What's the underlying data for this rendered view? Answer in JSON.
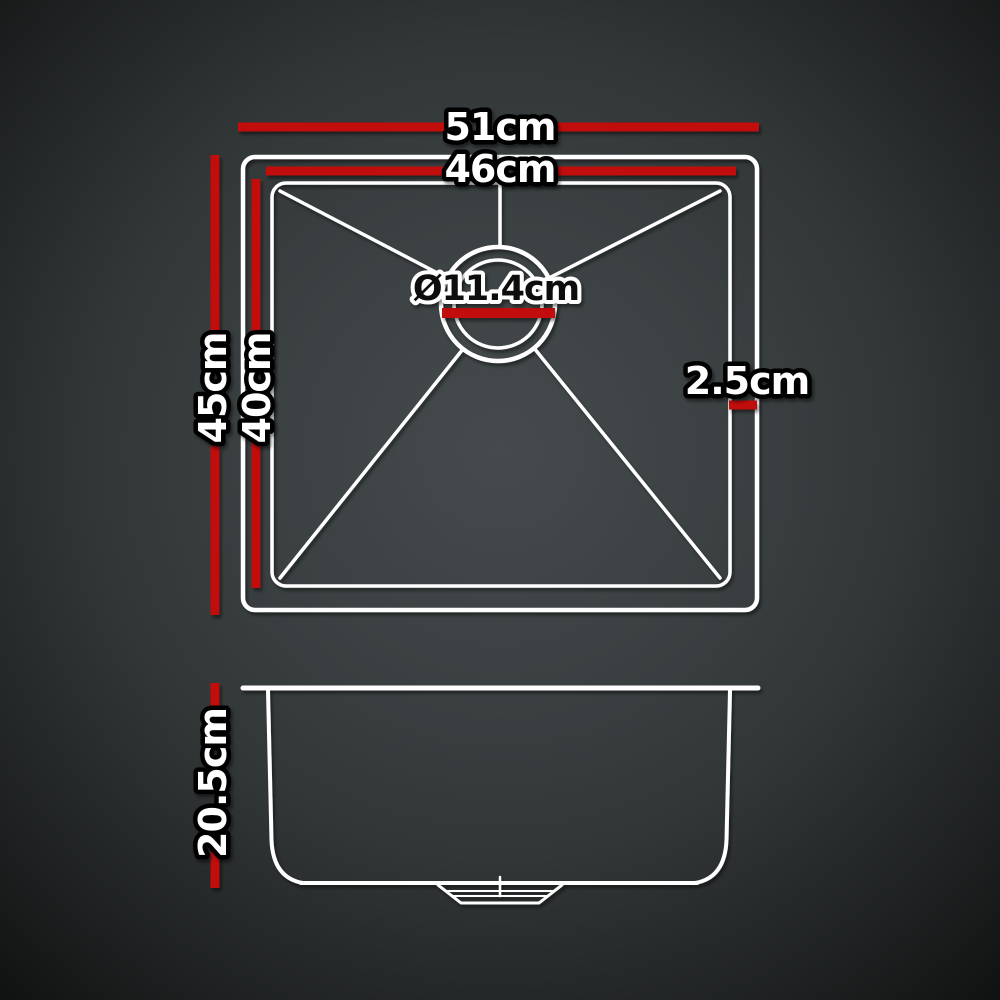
{
  "diagram": {
    "type": "product-dimension-diagram",
    "subject": "stainless-steel kitchen sink, top view and side view",
    "top_view": {
      "outer_width_label": "51cm",
      "inner_width_label": "46cm",
      "outer_height_label": "45cm",
      "inner_height_label": "40cm",
      "rim_thickness_label": "2.5cm",
      "drain_diameter_label": "Ø11.4cm"
    },
    "side_view": {
      "depth_label": "20.5cm"
    },
    "colors": {
      "dimension_red": "#c20d11",
      "line_white": "#ffffff",
      "label_fill": "#ffffff",
      "label_outline": "#000000",
      "drain_label_fill": "#0a0a0a",
      "drain_label_outline": "#ffffff",
      "background_center": "#454b4d",
      "background_edge": "#101212"
    }
  }
}
